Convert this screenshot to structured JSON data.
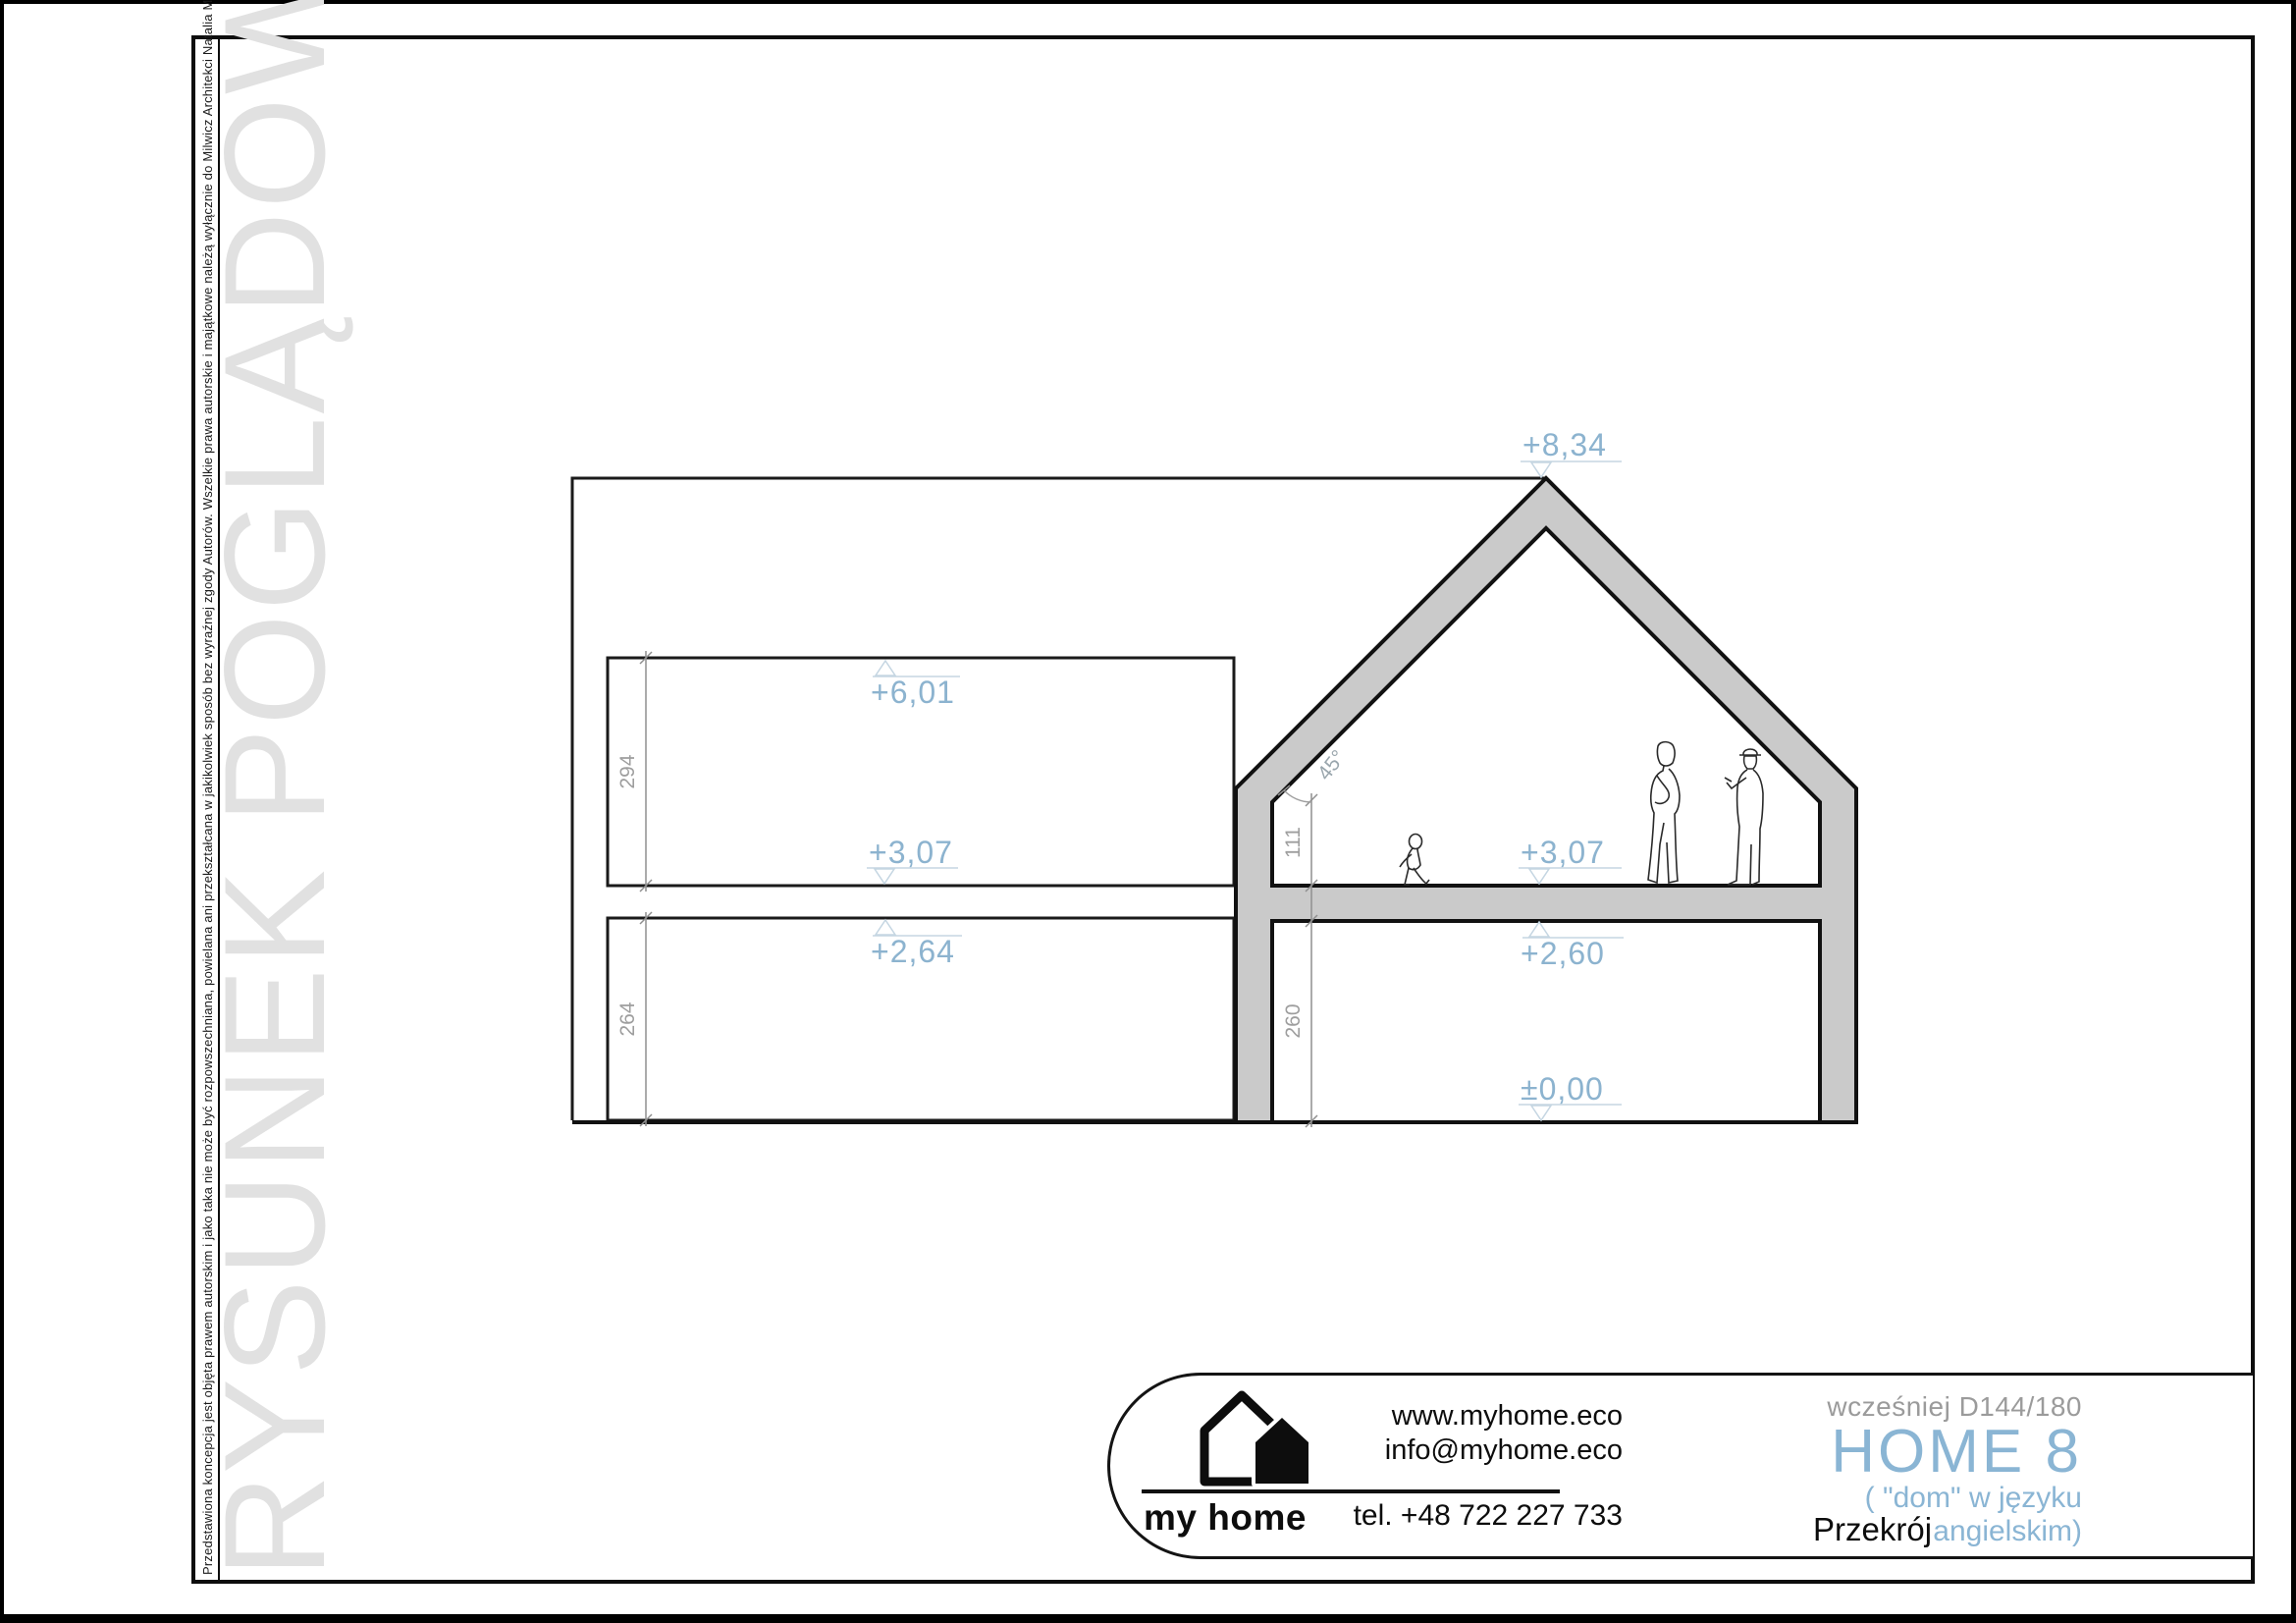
{
  "page": {
    "copyright_notice": "Przedstawiona koncepcja jest objęta prawem autorskim i jako taka nie może być rozpowszechniana, powielana ani przekształcana w jakikolwiek sposób bez wyraźnej zgody Autorów. Wszelkie prawa autorskie i majątkowe należą wyłącznie do Milwicz Architekci Natalia Milwicz",
    "watermark": "RYSUNEK POGLĄDOWY"
  },
  "drawing": {
    "levels": {
      "ridge": "+8,34",
      "attic_top_left": "+6,01",
      "attic_floor_left": "+3,07",
      "ceiling_left": "+2,64",
      "attic_floor_right": "+3,07",
      "ceiling_right": "+2,60",
      "ground_floor": "±0,00"
    },
    "dimensions": {
      "upper_room_height": "294",
      "lower_room_height": "264",
      "knee_wall_height": "111",
      "ground_room_height": "260",
      "roof_angle": "45°"
    }
  },
  "title_block": {
    "brand": {
      "name": "my home",
      "website": "www.myhome.eco",
      "email": "info@myhome.eco",
      "phone": "tel. +48 722 227 733"
    },
    "project": {
      "former_name": "wcześniej D144/180",
      "name": "HOME 8",
      "name_note": "( \"dom\" w języku angielskim)",
      "drawing_name": "Przekrój"
    }
  }
}
